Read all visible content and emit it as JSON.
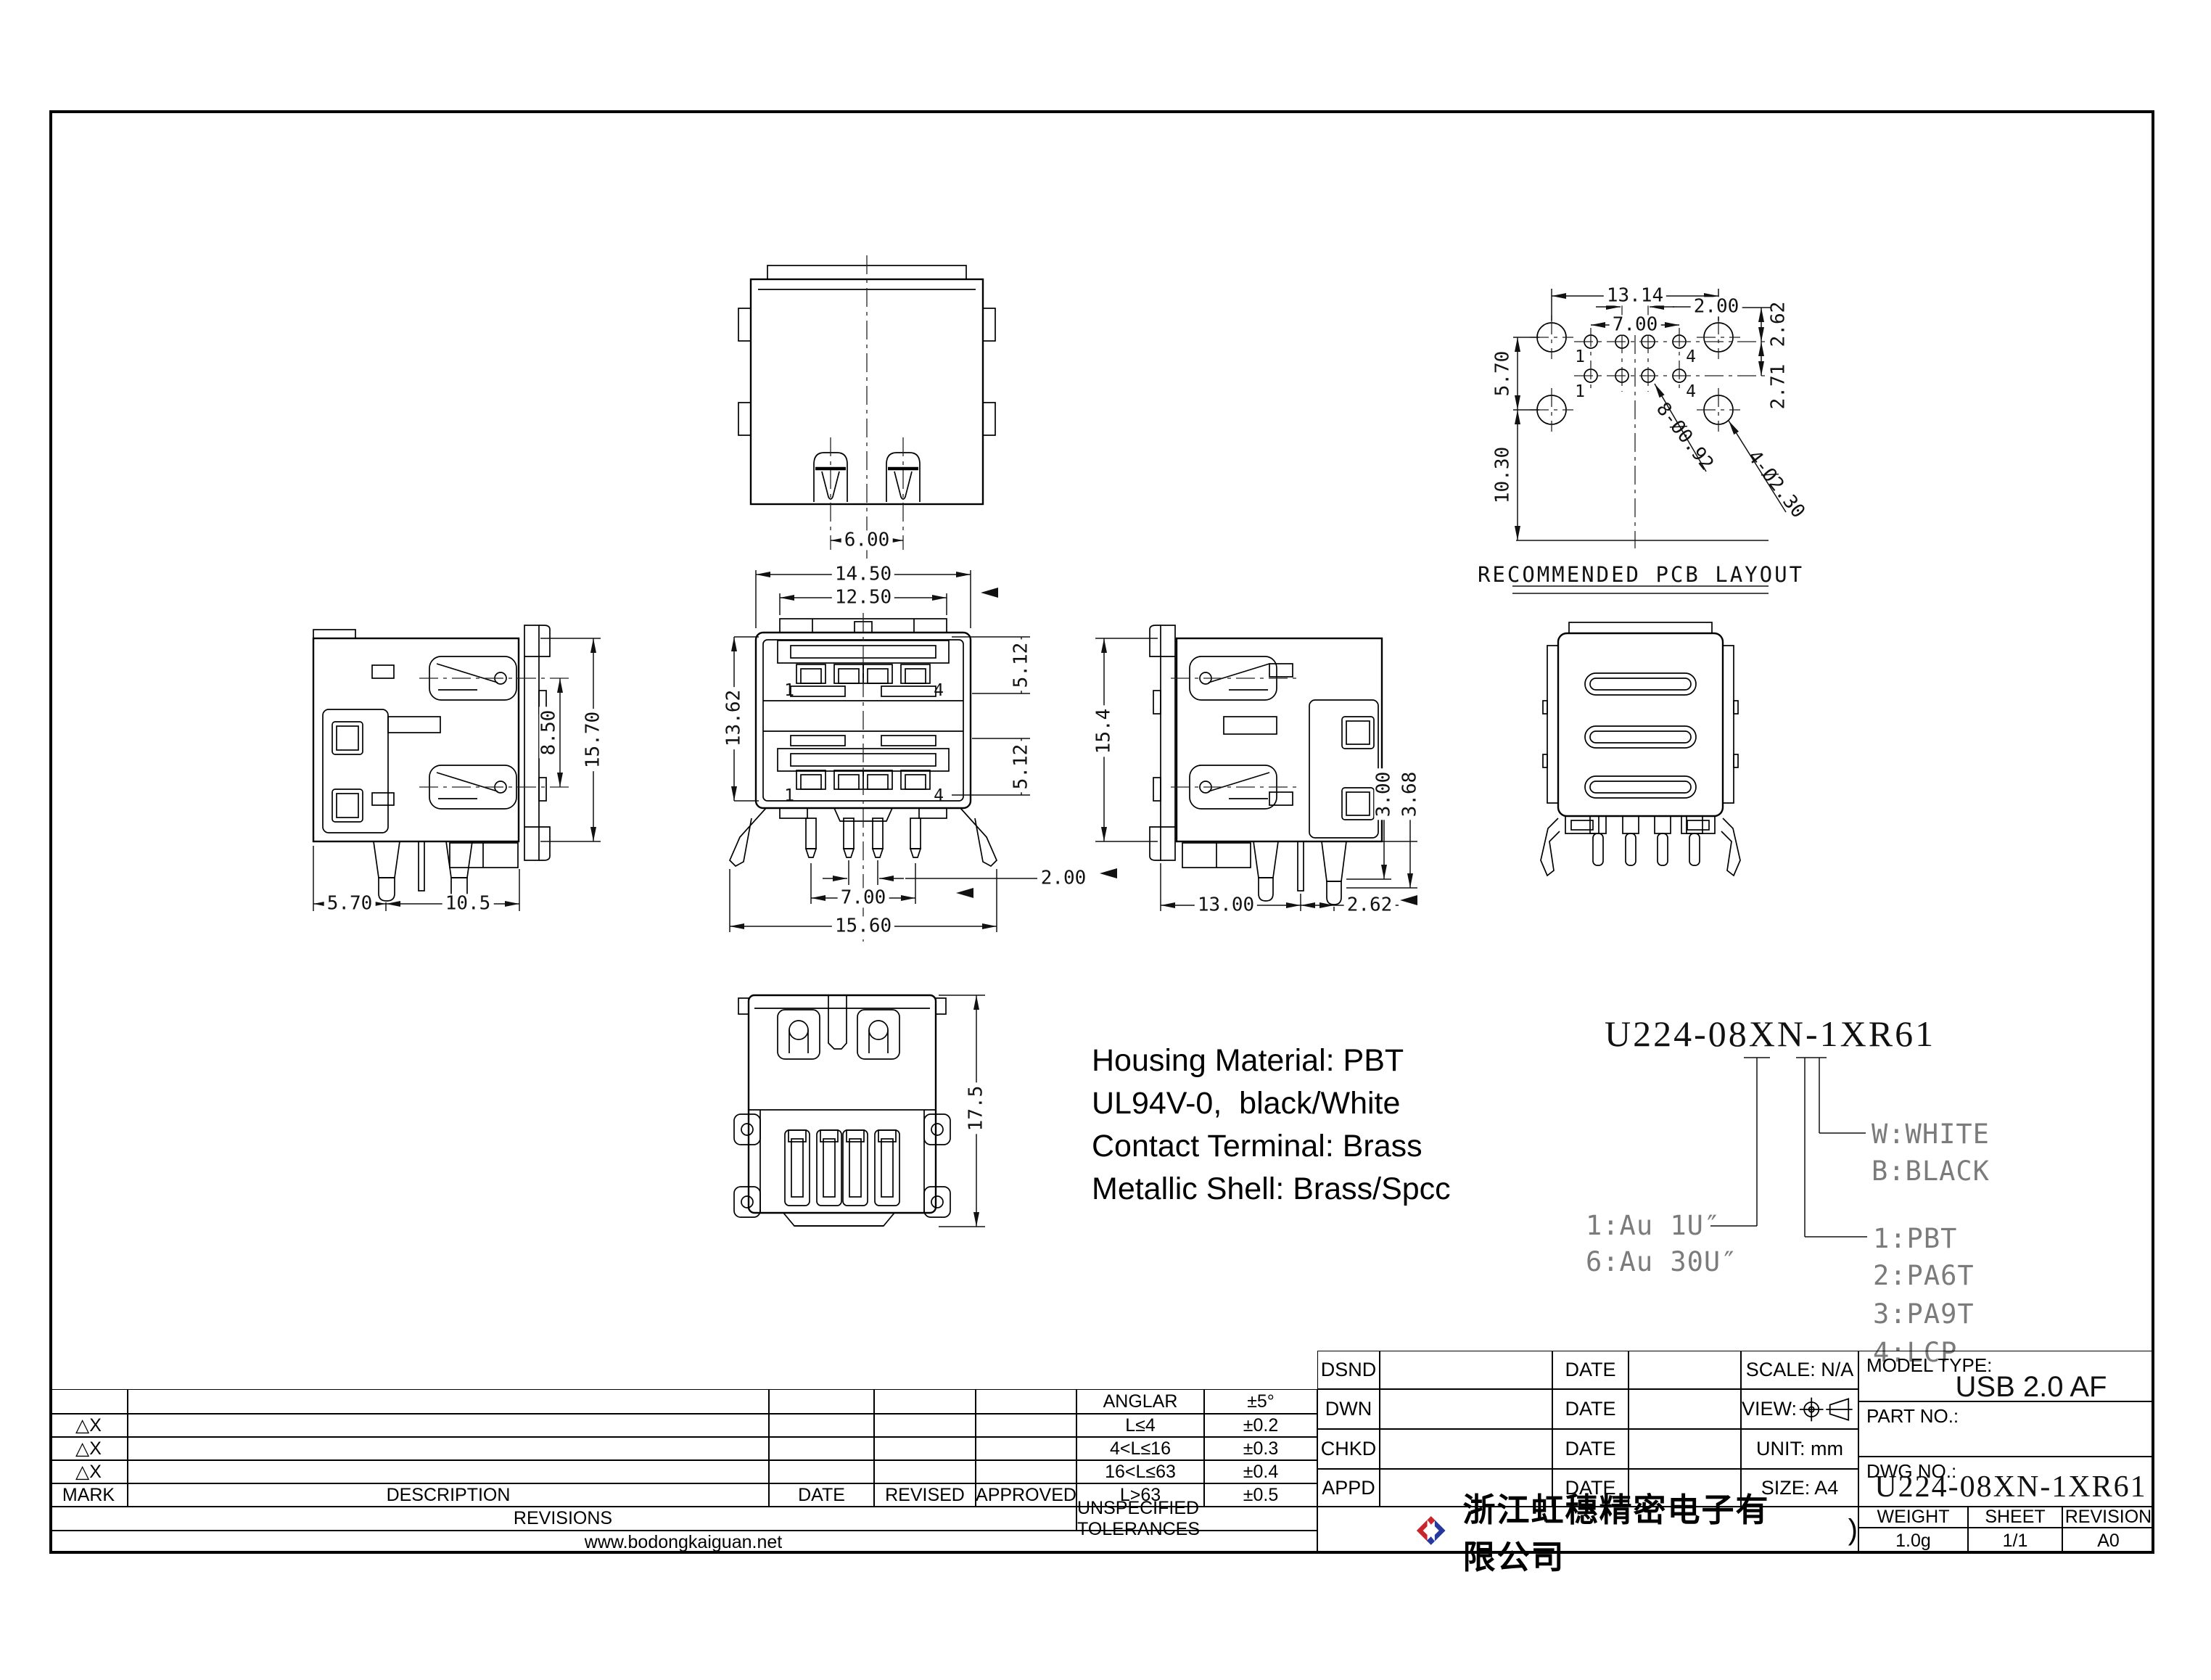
{
  "views": {
    "top": {
      "dim_width": "6.00"
    },
    "pcb": {
      "dim_13_14": "13.14",
      "dim_7_00": "7.00",
      "dim_2_00": "2.00",
      "dim_2_62": "2.62",
      "dim_5_70": "5.70",
      "dim_2_71": "2.71",
      "dim_10_30": "10.30",
      "callout_small_holes": "8-Ø0.92",
      "callout_big_holes": "4-Ø2.30",
      "pin_1": "1",
      "pin_4": "4",
      "caption": "RECOMMENDED PCB LAYOUT"
    },
    "side_left": {
      "dim_8_50": "8.50",
      "dim_15_70": "15.70",
      "dim_5_70": "5.70",
      "dim_10_5": "10.5"
    },
    "front": {
      "dim_14_50": "14.50",
      "dim_12_50": "12.50",
      "dim_13_62": "13.62",
      "dim_5_12_upper": "5.12",
      "dim_5_12_lower": "5.12",
      "dim_2_00": "2.00",
      "dim_7_00": "7.00",
      "dim_15_60": "15.60",
      "pin_1": "1",
      "pin_4": "4"
    },
    "side_right": {
      "dim_15_4": "15.4",
      "dim_3_00": "3.00",
      "dim_3_68": "3.68",
      "dim_13_00": "13.00",
      "dim_2_62": "2.62"
    },
    "bottom": {
      "dim_17_5": "17.5"
    }
  },
  "notes": [
    "Housing Material: PBT",
    "UL94V-0,  black/White",
    "Contact Terminal: Brass",
    "Metallic Shell: Brass/Spcc"
  ],
  "part_tree": {
    "part_number": "U224-08XN-1XR61",
    "plating_1": "1:Au 1U″",
    "plating_6": "6:Au 30U″",
    "color_w": "W:WHITE",
    "color_b": "B:BLACK",
    "material_1": "1:PBT",
    "material_2": "2:PA6T",
    "material_3": "3:PA9T",
    "material_4": "4:LCP"
  },
  "revisions": {
    "mark": "MARK",
    "description": "DESCRIPTION",
    "date": "DATE",
    "revised": "REVISED",
    "approved": "APPROVED",
    "title": "REVISIONS",
    "website": "www.bodongkaiguan.net",
    "mark_symbol": "△X"
  },
  "tolerances": {
    "title": "UNSPECIFIED TOLERANCES",
    "rows": [
      {
        "range": "ANGLAR",
        "tol": "±5°"
      },
      {
        "range": "L≤4",
        "tol": "±0.2"
      },
      {
        "range": "4<L≤16",
        "tol": "±0.3"
      },
      {
        "range": "16<L≤63",
        "tol": "±0.4"
      },
      {
        "range": "L>63",
        "tol": "±0.5"
      }
    ]
  },
  "title_block": {
    "dsnd": "DSND",
    "dwn": "DWN",
    "chkd": "CHKD",
    "appd": "APPD",
    "date": "DATE",
    "scale": "SCALE: N/A",
    "view": "VIEW:",
    "unit": "UNIT: mm",
    "size": "SIZE: A4",
    "model_type_label": "MODEL TYPE:",
    "model_type": "USB 2.0 AF",
    "part_no_label": "PART NO.:",
    "dwg_no_label": "DWG NO.:",
    "dwg_no": "U224-08XN-1XR61",
    "weight_label": "WEIGHT",
    "sheet_label": "SHEET",
    "revision_label": "REVISION",
    "weight": "1.0g",
    "sheet": "1/1",
    "revision": "A0",
    "company": "浙江虹穗精密电子有限公司",
    "company_mark": ")"
  },
  "colors": {
    "logo_red": "#cf2built",
    "logo_red_hex": "#c9252d",
    "logo_blue_hex": "#2438a0",
    "line": "#000000"
  }
}
